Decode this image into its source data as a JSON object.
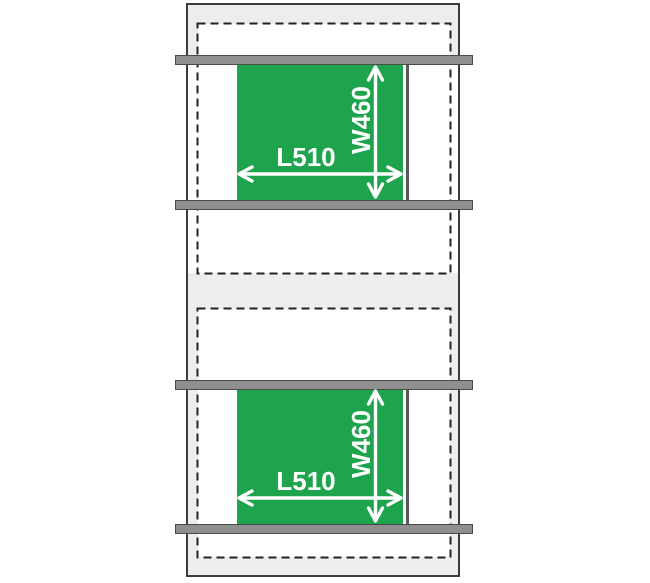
{
  "diagram": {
    "type": "shelf-mat-dimension-diagram",
    "mats": [
      {
        "length_label": "L510",
        "width_label": "W460"
      },
      {
        "length_label": "L510",
        "width_label": "W460"
      }
    ],
    "dimensions": {
      "length_mm": 510,
      "width_mm": 460
    },
    "colors": {
      "mat_green": "#1ea44d",
      "rail_gray": "#8f8f8f",
      "cabinet_fill": "#ededed",
      "outline_dark": "#3c3c3c",
      "dashed_line": "#222222",
      "dimension_text": "#ffffff"
    }
  }
}
